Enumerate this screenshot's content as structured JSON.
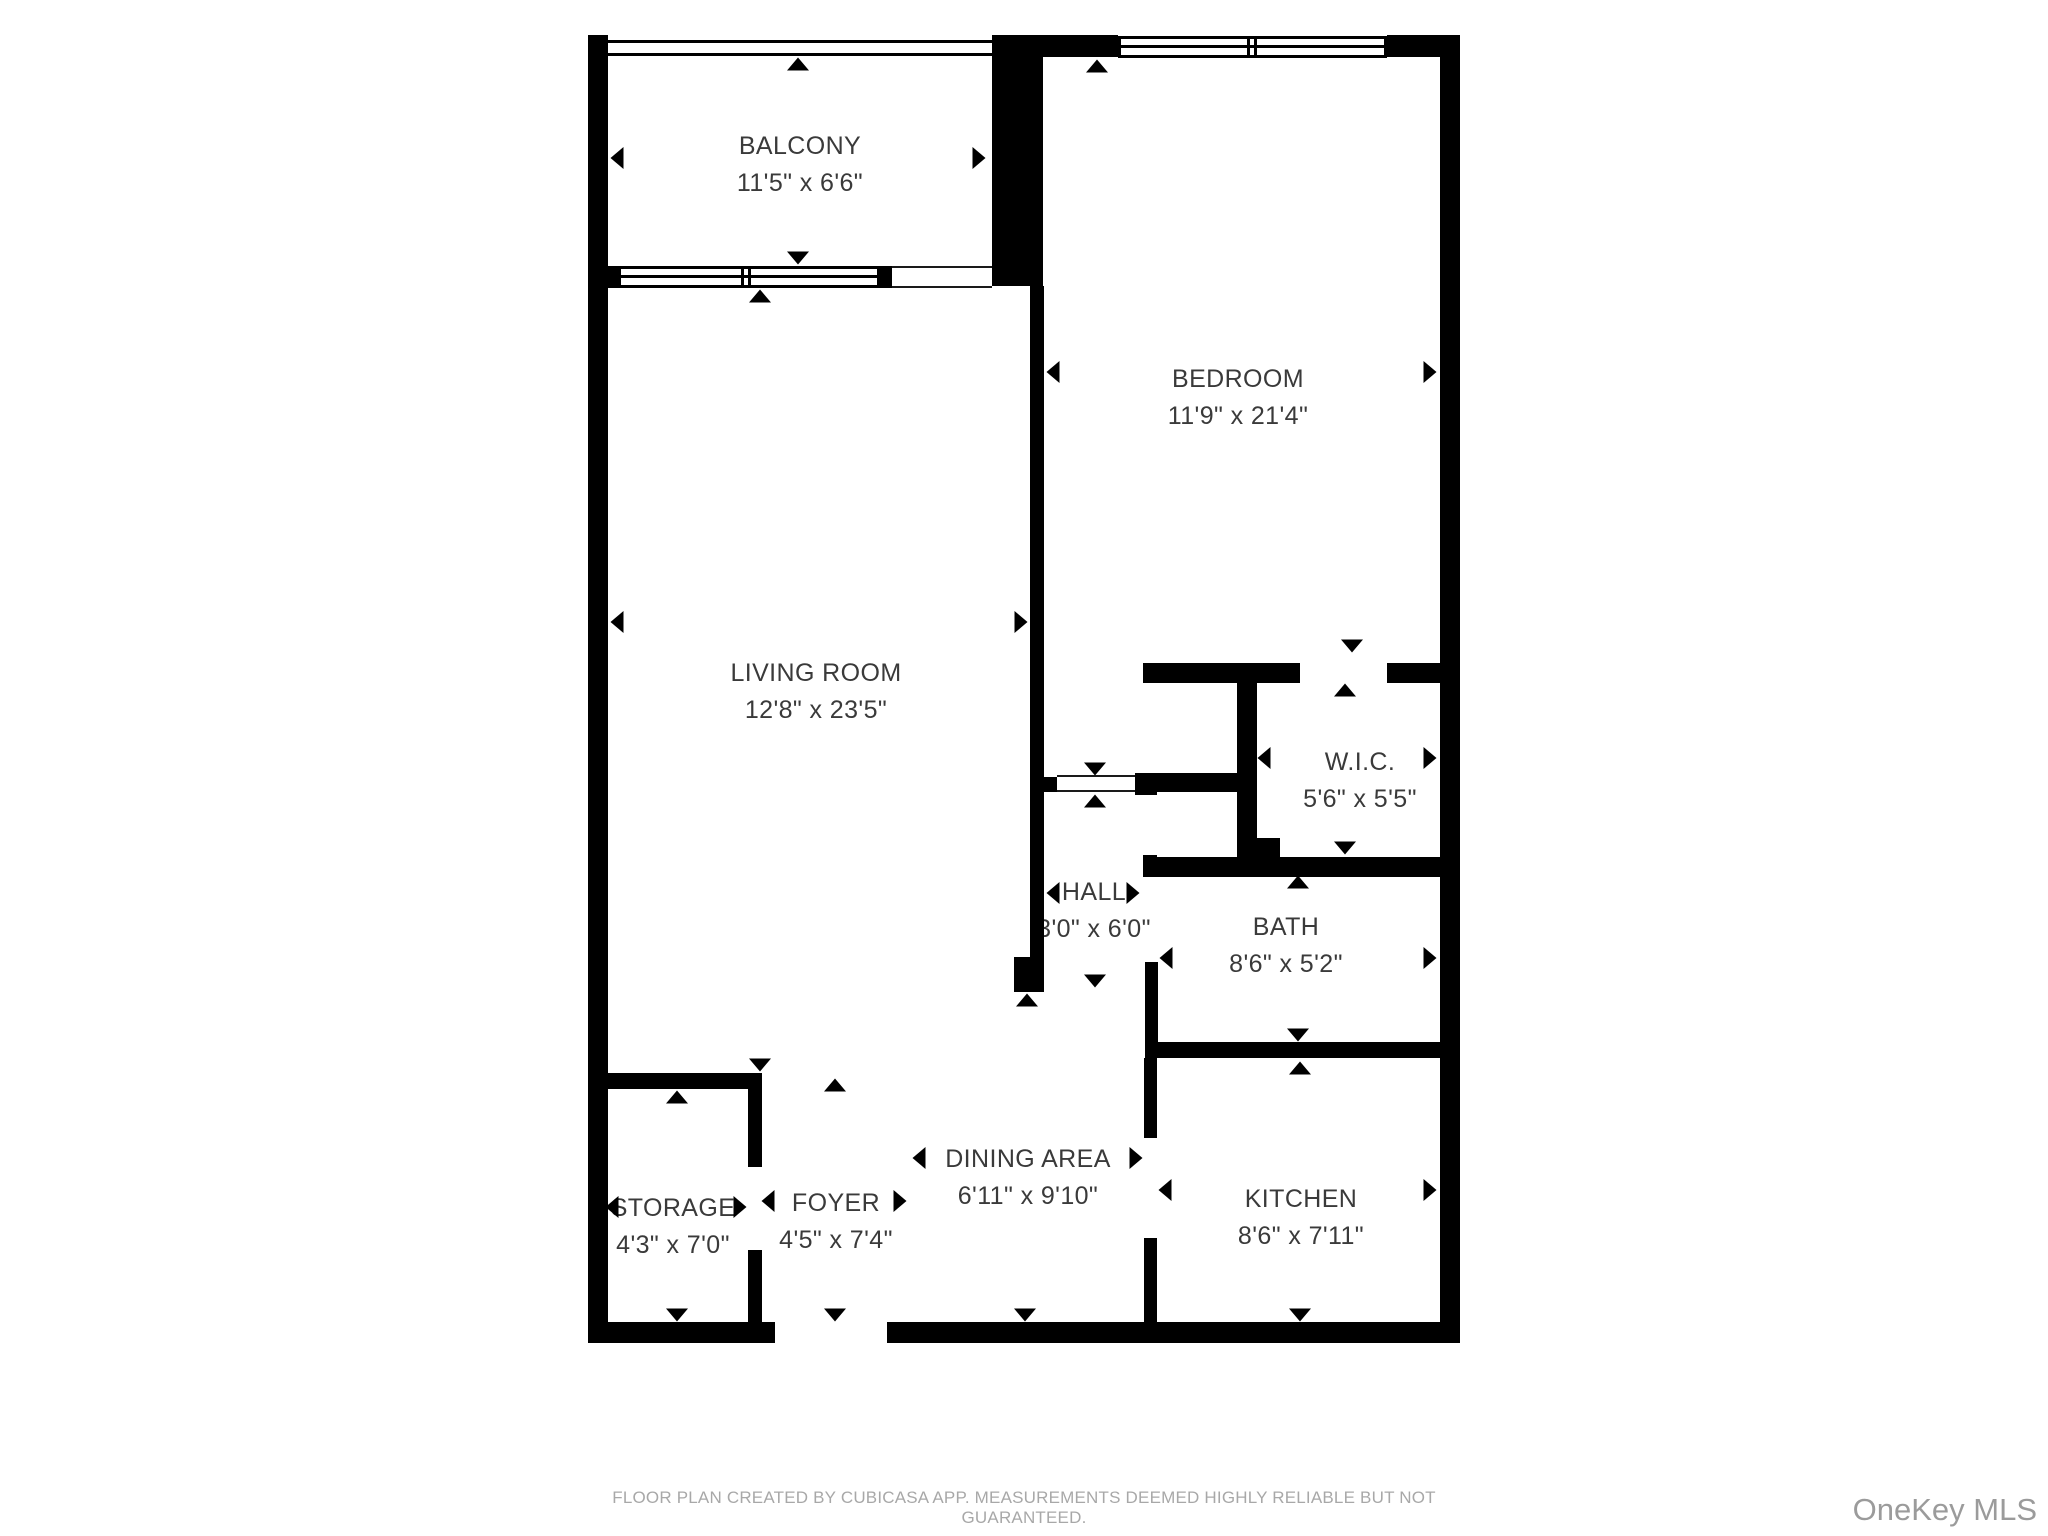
{
  "footer": {
    "disclaimer": "FLOOR PLAN CREATED BY CUBICASA APP. MEASUREMENTS DEEMED HIGHLY RELIABLE BUT NOT GUARANTEED."
  },
  "watermark": {
    "text": "OneKey MLS"
  },
  "floorplan": {
    "wall_color": "#000000",
    "label_color": "#3a3a3a",
    "rooms": [
      {
        "id": "balcony",
        "name": "BALCONY",
        "dims": "11'5\" x 6'6\"",
        "x": 800,
        "y": 147
      },
      {
        "id": "bedroom",
        "name": "BEDROOM",
        "dims": "11'9\" x 21'4\"",
        "x": 1238,
        "y": 380
      },
      {
        "id": "living-room",
        "name": "LIVING ROOM",
        "dims": "12'8\" x 23'5\"",
        "x": 816,
        "y": 674
      },
      {
        "id": "wic",
        "name": "W.I.C.",
        "dims": "5'6\" x 5'5\"",
        "x": 1360,
        "y": 763
      },
      {
        "id": "hall",
        "name": "HALL",
        "dims": "3'0\" x 6'0\"",
        "x": 1094,
        "y": 893
      },
      {
        "id": "bath",
        "name": "BATH",
        "dims": "8'6\" x 5'2\"",
        "x": 1286,
        "y": 928
      },
      {
        "id": "storage",
        "name": "STORAGE",
        "dims": "4'3\" x 7'0\"",
        "x": 673,
        "y": 1209
      },
      {
        "id": "foyer",
        "name": "FOYER",
        "dims": "4'5\" x 7'4\"",
        "x": 836,
        "y": 1204
      },
      {
        "id": "dining-area",
        "name": "DINING AREA",
        "dims": "6'11\" x 9'10\"",
        "x": 1028,
        "y": 1160
      },
      {
        "id": "kitchen",
        "name": "KITCHEN",
        "dims": "8'6\" x 7'11\"",
        "x": 1301,
        "y": 1200
      }
    ],
    "walls": [
      [
        588,
        35,
        20,
        1308
      ],
      [
        992,
        35,
        51,
        251
      ],
      [
        1043,
        35,
        75,
        22
      ],
      [
        1387,
        35,
        53,
        22
      ],
      [
        1440,
        35,
        20,
        1308
      ],
      [
        588,
        1322,
        187,
        21
      ],
      [
        887,
        1322,
        573,
        21
      ],
      [
        588,
        266,
        30,
        22
      ],
      [
        880,
        266,
        12,
        22
      ],
      [
        1030,
        286,
        14,
        671
      ],
      [
        1014,
        957,
        30,
        35
      ],
      [
        1043,
        777,
        14,
        15
      ],
      [
        1135,
        773,
        22,
        22
      ],
      [
        1143,
        663,
        157,
        20
      ],
      [
        1387,
        663,
        53,
        20
      ],
      [
        1141,
        773,
        96,
        19
      ],
      [
        1237,
        663,
        20,
        207
      ],
      [
        1257,
        838,
        23,
        32
      ],
      [
        1143,
        855,
        14,
        22
      ],
      [
        1143,
        857,
        317,
        20
      ],
      [
        1145,
        962,
        13,
        80
      ],
      [
        1145,
        1042,
        315,
        16
      ],
      [
        1144,
        1058,
        13,
        80
      ],
      [
        1144,
        1238,
        13,
        85
      ],
      [
        607,
        1073,
        155,
        16
      ],
      [
        748,
        1073,
        14,
        94
      ],
      [
        748,
        1250,
        14,
        73
      ]
    ],
    "railings": [
      [
        608,
        40,
        384,
        16
      ]
    ],
    "windows": [
      {
        "x": 1118,
        "y": 36,
        "w": 269,
        "h": 22,
        "divider": 1252
      },
      {
        "x": 618,
        "y": 266,
        "w": 262,
        "h": 22,
        "divider": 746
      }
    ],
    "openings": [
      [
        892,
        266,
        100,
        22
      ],
      [
        1057,
        775,
        78,
        17
      ]
    ],
    "arrows": [
      [
        "l",
        617,
        158
      ],
      [
        "r",
        979,
        158
      ],
      [
        "u",
        798,
        64
      ],
      [
        "d",
        798,
        258
      ],
      [
        "l",
        1053,
        372
      ],
      [
        "r",
        1430,
        372
      ],
      [
        "u",
        1097,
        66
      ],
      [
        "d",
        1095,
        769
      ],
      [
        "l",
        617,
        622
      ],
      [
        "r",
        1021,
        622
      ],
      [
        "u",
        760,
        296
      ],
      [
        "d",
        760,
        1065
      ],
      [
        "l",
        1264,
        758
      ],
      [
        "r",
        1430,
        758
      ],
      [
        "u",
        1345,
        690
      ],
      [
        "d",
        1345,
        848
      ],
      [
        "d",
        1352,
        646
      ],
      [
        "l",
        1053,
        893
      ],
      [
        "r",
        1133,
        893
      ],
      [
        "u",
        1095,
        801
      ],
      [
        "d",
        1095,
        981
      ],
      [
        "l",
        1166,
        958
      ],
      [
        "r",
        1430,
        958
      ],
      [
        "u",
        1298,
        882
      ],
      [
        "d",
        1298,
        1035
      ],
      [
        "l",
        612,
        1207
      ],
      [
        "r",
        740,
        1207
      ],
      [
        "u",
        677,
        1097
      ],
      [
        "d",
        677,
        1315
      ],
      [
        "l",
        768,
        1201
      ],
      [
        "r",
        900,
        1201
      ],
      [
        "u",
        835,
        1085
      ],
      [
        "d",
        835,
        1315
      ],
      [
        "l",
        919,
        1158
      ],
      [
        "r",
        1136,
        1158
      ],
      [
        "u",
        1027,
        1000
      ],
      [
        "d",
        1025,
        1315
      ],
      [
        "l",
        1165,
        1190
      ],
      [
        "r",
        1430,
        1190
      ],
      [
        "u",
        1300,
        1068
      ],
      [
        "d",
        1300,
        1315
      ]
    ]
  }
}
